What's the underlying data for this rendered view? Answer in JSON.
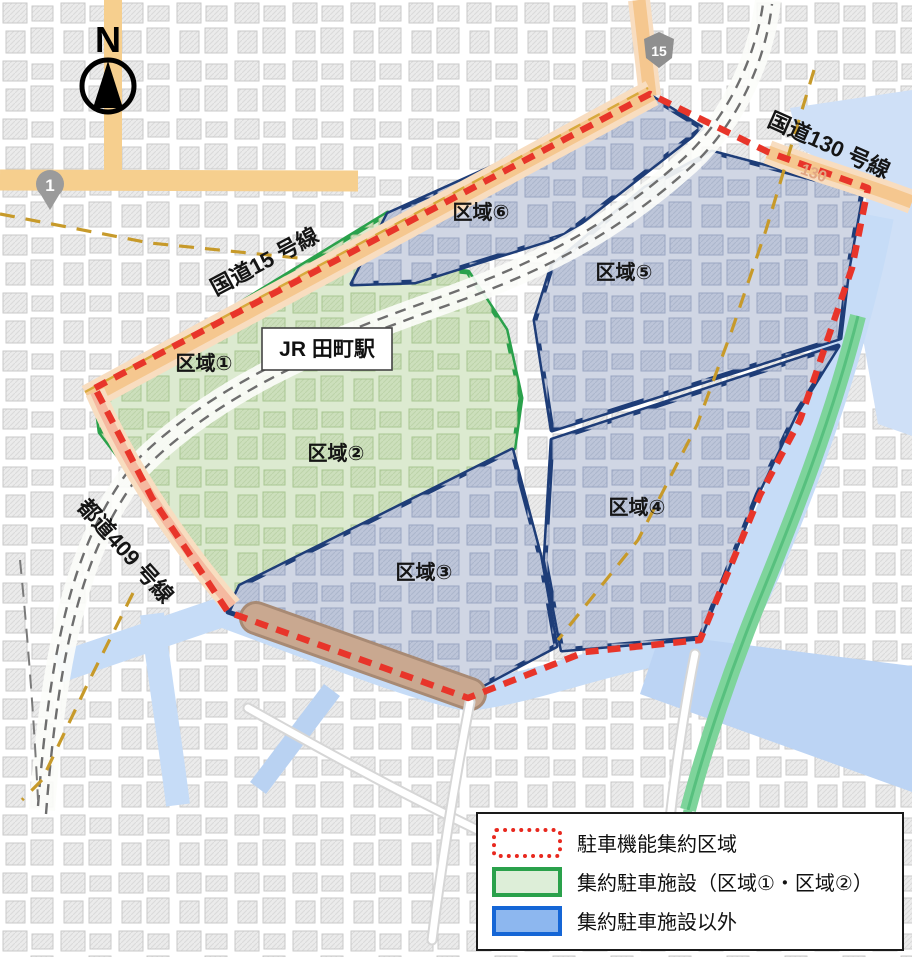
{
  "map": {
    "compass": "N",
    "station": "JR 田町駅",
    "roads": [
      {
        "id": "route15",
        "label": "国道15 号線"
      },
      {
        "id": "route130",
        "label": "国道130 号線"
      },
      {
        "id": "route409",
        "label": "都道409 号線"
      }
    ],
    "route_shields": [
      {
        "id": "shield-1",
        "label": "1"
      },
      {
        "id": "shield-15",
        "label": "15"
      },
      {
        "id": "shield-130",
        "label": "130"
      }
    ],
    "zones": [
      {
        "id": "zone-1",
        "label": "区域①"
      },
      {
        "id": "zone-2",
        "label": "区域②"
      },
      {
        "id": "zone-3",
        "label": "区域③"
      },
      {
        "id": "zone-4",
        "label": "区域④"
      },
      {
        "id": "zone-5",
        "label": "区域⑤"
      },
      {
        "id": "zone-6",
        "label": "区域⑥"
      }
    ]
  },
  "legend": {
    "items": [
      {
        "label": "駐車機能集約区域",
        "swatch": "red-dotted-outline"
      },
      {
        "label": "集約駐車施設（区域①・区域②）",
        "swatch": "green-fill"
      },
      {
        "label": "集約駐車施設以外",
        "swatch": "blue-fill"
      }
    ]
  },
  "colors": {
    "boundary_red": "#e8352a",
    "zone_border_navy": "#1e3d78",
    "zone_border_green": "#2aa14b",
    "green_zone_fill": "#dcead0",
    "blue_zone_fill": "#d0d6e4",
    "water": "#c6dcf7",
    "road_orange": "#f5c78f",
    "expressway_green": "#7ed49b"
  }
}
